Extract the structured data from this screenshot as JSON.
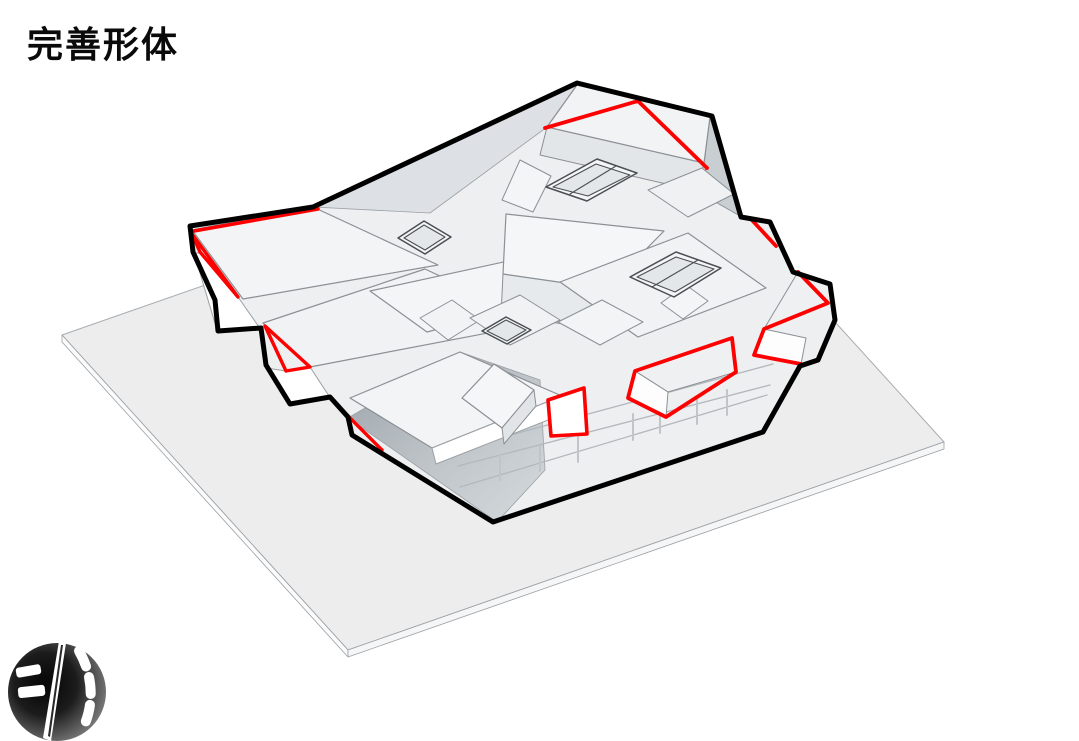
{
  "title": "完善形体",
  "logo": {
    "name": "ink-sphere-logo"
  },
  "colors": {
    "outline": "#000000",
    "highlight": "#fe0000",
    "ground": "#ededee",
    "mass": "#edeff0",
    "roof": "#f3f4f5",
    "edge": "#8b9095"
  },
  "scene": {
    "width": 1079,
    "height": 741,
    "shapes": [
      {
        "name": "ground-plane-top",
        "type": "polygon",
        "points": "62,335 658,127 944,442 348,650",
        "fill": "#ededee",
        "stroke": "#a8adb2",
        "sw": 1
      },
      {
        "name": "ground-plane-side-left",
        "type": "polygon",
        "points": "62,335 348,650 348,657 62,342",
        "fill": "#fbfbfc",
        "stroke": "#9aa0a5",
        "sw": 0.8
      },
      {
        "name": "ground-plane-side-right",
        "type": "polygon",
        "points": "348,650 944,442 944,449 348,657",
        "fill": "#f6f6f7",
        "stroke": "#9aa0a5",
        "sw": 0.8
      },
      {
        "name": "building-base-mass",
        "type": "polygon",
        "points": "190,226 313,207 577,83 712,116 741,217 770,222 793,272 830,284 835,320 818,360 800,366 763,432 493,522 352,435 348,417 330,397 290,404 266,365 261,328 218,331 215,300 193,252",
        "fill": "#edeff0",
        "stroke": "none",
        "sw": 0
      },
      {
        "name": "inner-slope-band",
        "type": "polygon",
        "points": "313,207 577,85 547,127 430,213",
        "fill": "#dde1e5",
        "stroke": "#9aa0a5",
        "sw": 0.8
      },
      {
        "name": "lower-slope-face",
        "type": "polygon",
        "points": "348,418 497,522 545,470 540,380 460,352",
        "fill": "none",
        "grad": "slopeGrad",
        "stroke": "#9aa0a5",
        "sw": 0.8
      },
      {
        "name": "floor-line-1",
        "type": "polyline",
        "points": "470,446 773,364",
        "fill": "none",
        "stroke": "#b2b8bd",
        "sw": 1.3
      },
      {
        "name": "floor-line-2",
        "type": "polyline",
        "points": "458,466 770,385",
        "fill": "none",
        "stroke": "#b2b8bd",
        "sw": 1.3
      },
      {
        "name": "floor-line-3",
        "type": "polyline",
        "points": "460,487 767,395",
        "fill": "none",
        "stroke": "#b2b8bd",
        "sw": 1.3
      },
      {
        "name": "fin-1",
        "type": "polyline",
        "points": "500,455 500,480",
        "fill": "none",
        "stroke": "#c0c5ca",
        "sw": 2
      },
      {
        "name": "fin-2",
        "type": "polyline",
        "points": "540,446 540,471",
        "fill": "none",
        "stroke": "#c0c5ca",
        "sw": 2
      },
      {
        "name": "fin-3",
        "type": "polyline",
        "points": "578,437 578,462",
        "fill": "none",
        "stroke": "#c0c5ca",
        "sw": 2
      },
      {
        "name": "fin-4",
        "type": "polyline",
        "points": "633,414 633,440",
        "fill": "none",
        "stroke": "#c0c5ca",
        "sw": 2
      },
      {
        "name": "fin-5",
        "type": "polyline",
        "points": "660,407 660,433",
        "fill": "none",
        "stroke": "#c0c5ca",
        "sw": 2
      },
      {
        "name": "fin-6",
        "type": "polyline",
        "points": "697,398 697,424",
        "fill": "none",
        "stroke": "#c0c5ca",
        "sw": 2
      },
      {
        "name": "fin-7",
        "type": "polyline",
        "points": "727,390 727,415",
        "fill": "none",
        "stroke": "#c0c5ca",
        "sw": 2
      },
      {
        "name": "bar1-roof",
        "type": "polygon",
        "points": "192,230 313,207 438,265 243,299",
        "fill": "#f3f4f5",
        "stroke": "#8b9095",
        "sw": 1.2
      },
      {
        "name": "step1-front-face",
        "type": "polygon",
        "points": "194,253 217,330 259,327 238,297 201,253",
        "fill": "#ffffff",
        "stroke": "#9aa0a5",
        "sw": 1
      },
      {
        "name": "bar2-roof",
        "type": "polygon",
        "points": "263,323 425,269 540,323 310,367",
        "fill": "#f1f2f3",
        "stroke": "#8b9095",
        "sw": 1.2
      },
      {
        "name": "step2-front-face",
        "type": "polygon",
        "points": "266,368 290,403 329,396 310,367 286,371",
        "fill": "#ffffff",
        "stroke": "#9aa0a5",
        "sw": 1
      },
      {
        "name": "left-big-roof",
        "type": "polygon",
        "points": "370,291 522,258 578,293 427,332",
        "fill": "#f4f5f6",
        "stroke": "#8b9095",
        "sw": 1.2
      },
      {
        "name": "bar3-roof",
        "type": "polygon",
        "points": "350,398 460,352 562,396 432,448",
        "fill": "#f3f4f5",
        "stroke": "#8b9095",
        "sw": 1.2
      },
      {
        "name": "bar3-front-face",
        "type": "polygon",
        "points": "432,448 562,396 566,413 436,464",
        "fill": "#ffffff",
        "stroke": "#9aa0a5",
        "sw": 1
      },
      {
        "name": "center-box-front",
        "type": "polygon",
        "points": "503,274 607,289 605,330 501,315",
        "fill": "#e7eaec",
        "stroke": "#8b9095",
        "sw": 1
      },
      {
        "name": "center-box-roof",
        "type": "polygon",
        "points": "506,214 664,231 607,289 503,274",
        "fill": "#f5f6f7",
        "stroke": "#8b9095",
        "sw": 1.2
      },
      {
        "name": "topright-box-front",
        "type": "polygon",
        "points": "547,127 704,163 697,191 540,155",
        "fill": "#e3e6e9",
        "stroke": "#8b9095",
        "sw": 1
      },
      {
        "name": "topright-box-side",
        "type": "polygon",
        "points": "704,163 710,117 740,216 712,200",
        "fill": "#c9ced3",
        "stroke": "#8b9095",
        "sw": 1
      },
      {
        "name": "topright-box-roof",
        "type": "polygon",
        "points": "577,85 710,117 704,163 547,127",
        "fill": "#f2f3f4",
        "stroke": "#8b9095",
        "sw": 1.2
      },
      {
        "name": "tilted-small-roof",
        "type": "polygon",
        "points": "502,200 520,160 551,176 533,212",
        "fill": "#f4f5f6",
        "stroke": "#8b9095",
        "sw": 1
      },
      {
        "name": "right-small-roof",
        "type": "polygon",
        "points": "648,190 702,168 734,194 688,217",
        "fill": "#eff1f2",
        "stroke": "#8b9095",
        "sw": 1
      },
      {
        "name": "right-center-roof",
        "type": "polygon",
        "points": "560,282 688,233 766,288 638,337",
        "fill": "#f0f2f3",
        "stroke": "#8b9095",
        "sw": 1.2
      },
      {
        "name": "small-box-a",
        "type": "polygon",
        "points": "420,318 452,300 480,320 448,340",
        "fill": "#f2f3f4",
        "stroke": "#8b9095",
        "sw": 1
      },
      {
        "name": "small-box-b",
        "type": "polygon",
        "points": "558,322 602,300 643,322 600,345",
        "fill": "#f3f4f5",
        "stroke": "#8b9095",
        "sw": 1
      },
      {
        "name": "small-box-c",
        "type": "polygon",
        "points": "470,318 520,295 560,320 510,345",
        "fill": "#f1f2f3",
        "stroke": "#8b9095",
        "sw": 1
      },
      {
        "name": "small-box-d",
        "type": "polygon",
        "points": "661,303 686,285 708,301 683,319",
        "fill": "#f4f5f6",
        "stroke": "#8b9095",
        "sw": 1
      },
      {
        "name": "center-house-roof",
        "type": "polygon",
        "points": "462,398 494,364 534,390 502,428",
        "fill": "#f5f6f7",
        "stroke": "#8b9095",
        "sw": 1.2
      },
      {
        "name": "center-house-side",
        "type": "polygon",
        "points": "502,428 534,390 536,406 504,444",
        "fill": "#e2e5e8",
        "stroke": "#8b9095",
        "sw": 1
      },
      {
        "name": "wedge-d-top-face",
        "type": "polygon",
        "points": "635,371 732,338 736,372 668,392",
        "fill": "#eef0f1",
        "stroke": "#8b9095",
        "sw": 1
      },
      {
        "name": "wedge-d-front-face",
        "type": "polygon",
        "points": "628,398 635,371 668,392 666,417",
        "fill": "#fdfdfd",
        "stroke": "#8b9095",
        "sw": 1
      },
      {
        "name": "wedge-c-top-face",
        "type": "polygon",
        "points": "798,272 828,303 764,329",
        "fill": "#eef0f1",
        "stroke": "#8b9095",
        "sw": 1
      },
      {
        "name": "wedge-c-front-face",
        "type": "polygon",
        "points": "764,329 754,355 801,364 806,338",
        "fill": "#fdfdfd",
        "stroke": "#8b9095",
        "sw": 1
      },
      {
        "name": "quad-e-face",
        "type": "polygon",
        "points": "548,400 584,388 587,434 551,436",
        "fill": "#ffffff",
        "stroke": "none",
        "sw": 0
      },
      {
        "name": "skylight-a-outer",
        "type": "polygon",
        "points": "546,187 597,159 637,173 587,201",
        "fill": "#f4f5f6",
        "stroke": "#4a4f54",
        "sw": 1.5
      },
      {
        "name": "skylight-a-inner",
        "type": "polygon",
        "points": "553,187 596,164 630,175 588,196",
        "fill": "#e4e7ea",
        "stroke": "#4a4f54",
        "sw": 1.1
      },
      {
        "name": "skylight-a-divider",
        "type": "polyline",
        "points": "570,194 616,166",
        "fill": "none",
        "stroke": "#4a4f54",
        "sw": 1.1
      },
      {
        "name": "skylight-b-outer",
        "type": "polygon",
        "points": "630,277 676,252 721,268 674,297",
        "fill": "#f4f5f6",
        "stroke": "#4a4f54",
        "sw": 1.5
      },
      {
        "name": "skylight-b-inner",
        "type": "polygon",
        "points": "637,277 676,257 714,269 675,292",
        "fill": "#e4e7ea",
        "stroke": "#4a4f54",
        "sw": 1.1
      },
      {
        "name": "skylight-b-divider",
        "type": "polyline",
        "points": "652,287 698,260",
        "fill": "none",
        "stroke": "#4a4f54",
        "sw": 1.1
      },
      {
        "name": "skylight-c-outer",
        "type": "polygon",
        "points": "398,238 424,221 451,237 425,254",
        "fill": "#f4f5f6",
        "stroke": "#4a4f54",
        "sw": 1.5
      },
      {
        "name": "skylight-c-inner",
        "type": "polygon",
        "points": "404,238 424,225 445,237 425,250",
        "fill": "#e4e7ea",
        "stroke": "#4a4f54",
        "sw": 1.1
      },
      {
        "name": "skylight-d-outer",
        "type": "polygon",
        "points": "482,331 506,317 531,330 507,344",
        "fill": "#f4f5f6",
        "stroke": "#4a4f54",
        "sw": 1.5
      },
      {
        "name": "skylight-d-inner",
        "type": "polygon",
        "points": "487,331 506,320 526,330 507,341",
        "fill": "#e4e7ea",
        "stroke": "#4a4f54",
        "sw": 1.1
      },
      {
        "name": "red-left-boundary-line",
        "type": "polyline",
        "points": "194,231 318,209",
        "fill": "none",
        "stroke": "#fe0000",
        "sw": 3.6
      },
      {
        "name": "red-step1-triangle",
        "type": "polygon",
        "points": "192,234 238,297 200,252",
        "fill": "none",
        "stroke": "#fe0000",
        "sw": 3.4
      },
      {
        "name": "red-step2-triangle",
        "type": "polygon",
        "points": "265,326 310,367 286,371",
        "fill": "none",
        "stroke": "#fe0000",
        "sw": 3.4
      },
      {
        "name": "red-slope-segment",
        "type": "polyline",
        "points": "349,417 382,450",
        "fill": "none",
        "stroke": "#fe0000",
        "sw": 3.4
      },
      {
        "name": "red-top-ridge-line",
        "type": "polyline",
        "points": "545,128 638,101 707,168",
        "fill": "none",
        "stroke": "#fe0000",
        "sw": 3.8
      },
      {
        "name": "red-right-segment",
        "type": "polyline",
        "points": "750,218 776,246",
        "fill": "none",
        "stroke": "#fe0000",
        "sw": 3.8
      },
      {
        "name": "red-wedge-c-outline",
        "type": "polyline",
        "points": "798,272 828,303 764,329 754,355 801,364",
        "fill": "none",
        "stroke": "#fe0000",
        "sw": 3.8
      },
      {
        "name": "red-wedge-d-outline",
        "type": "polygon",
        "points": "628,398 635,371 732,338 736,372 666,417",
        "fill": "none",
        "stroke": "#fe0000",
        "sw": 3.8
      },
      {
        "name": "red-quad-e-outline",
        "type": "polygon",
        "points": "548,400 584,388 587,434 551,436",
        "fill": "none",
        "stroke": "#fe0000",
        "sw": 3.6
      },
      {
        "name": "building-silhouette-outline",
        "type": "polygon",
        "points": "190,226 313,207 577,83 712,116 741,217 770,222 793,272 830,284 835,320 818,360 800,366 763,432 493,522 352,435 348,417 330,397 290,404 266,365 261,328 218,331 215,300 193,252",
        "fill": "none",
        "stroke": "#000000",
        "sw": 5
      }
    ]
  }
}
